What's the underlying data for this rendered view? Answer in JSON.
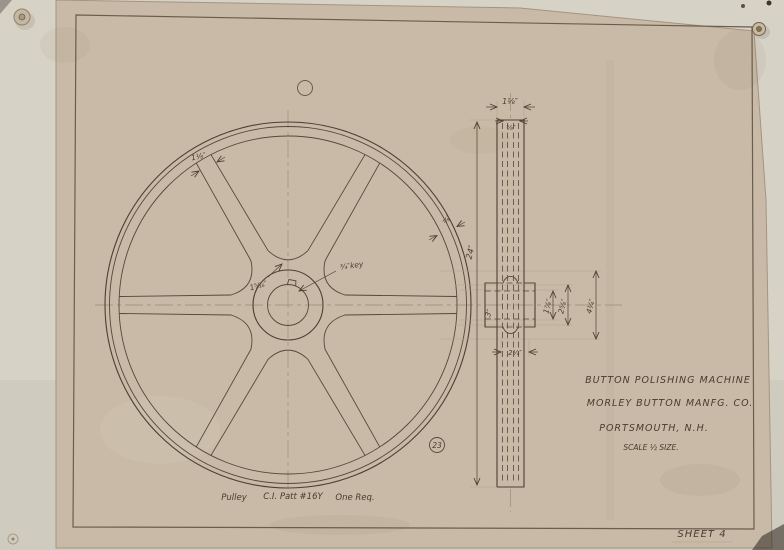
{
  "photo": {
    "description_labels": {
      "sheet_label": "SHEET 4"
    },
    "colors": {
      "paper": "#c8baa7",
      "backing": "#d7d2c6",
      "ink": "#4a4034",
      "faint_line": "#b3a48c"
    }
  },
  "title_block": {
    "line1": "BUTTON POLISHING MACHINE",
    "line2": "MORLEY BUTTON MANFG. CO.",
    "line3": "PORTSMOUTH, N.H.",
    "scale": "SCALE ½ SIZE."
  },
  "part_note": {
    "part": "Pulley",
    "material": "C.I. Patt #16Y",
    "quantity": "One Req."
  },
  "sheet_label": "SHEET 4",
  "balloon_number": "23",
  "dimensions": {
    "wheel_diameter": "24″",
    "rim_face_width": "1⅛″",
    "rim_inner": "⅝″",
    "rim_depth": "⅞″",
    "spoke_width_rim": "1⅛″",
    "spoke_width_hub": "1⁵⁄₁₆″",
    "key_note": "¾″key",
    "bore_diameter": "1⅞″",
    "hub_diameter": "2⅝″",
    "hub_flange": "4¼″",
    "hub_length": "3″",
    "hub_lower": "2¼″"
  }
}
